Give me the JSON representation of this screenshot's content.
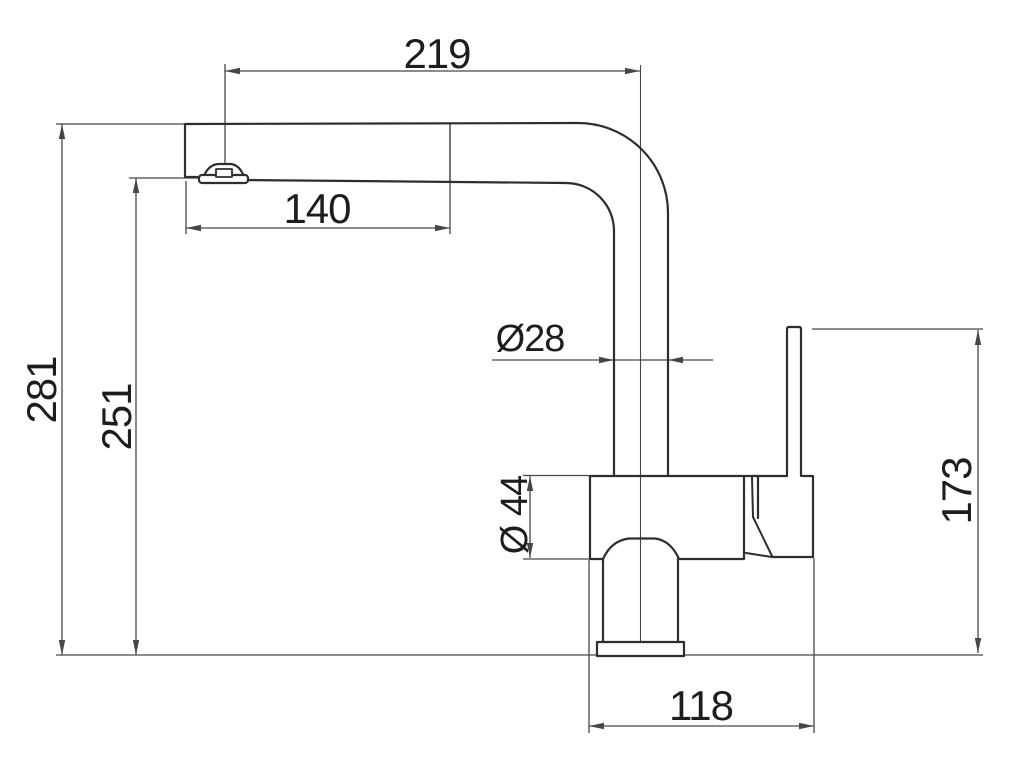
{
  "dimensions": {
    "spout_reach": "219",
    "aerator_offset": "140",
    "total_height": "281",
    "outlet_height": "251",
    "spout_tube_diameter": "Ø28",
    "body_diameter": "Ø 44",
    "handle_height": "173",
    "base_width": "118"
  },
  "colors": {
    "outline": "#2e2e2e",
    "dimension_lines": "#474747",
    "label_text": "#1d1d1d",
    "background": "#ffffff"
  }
}
